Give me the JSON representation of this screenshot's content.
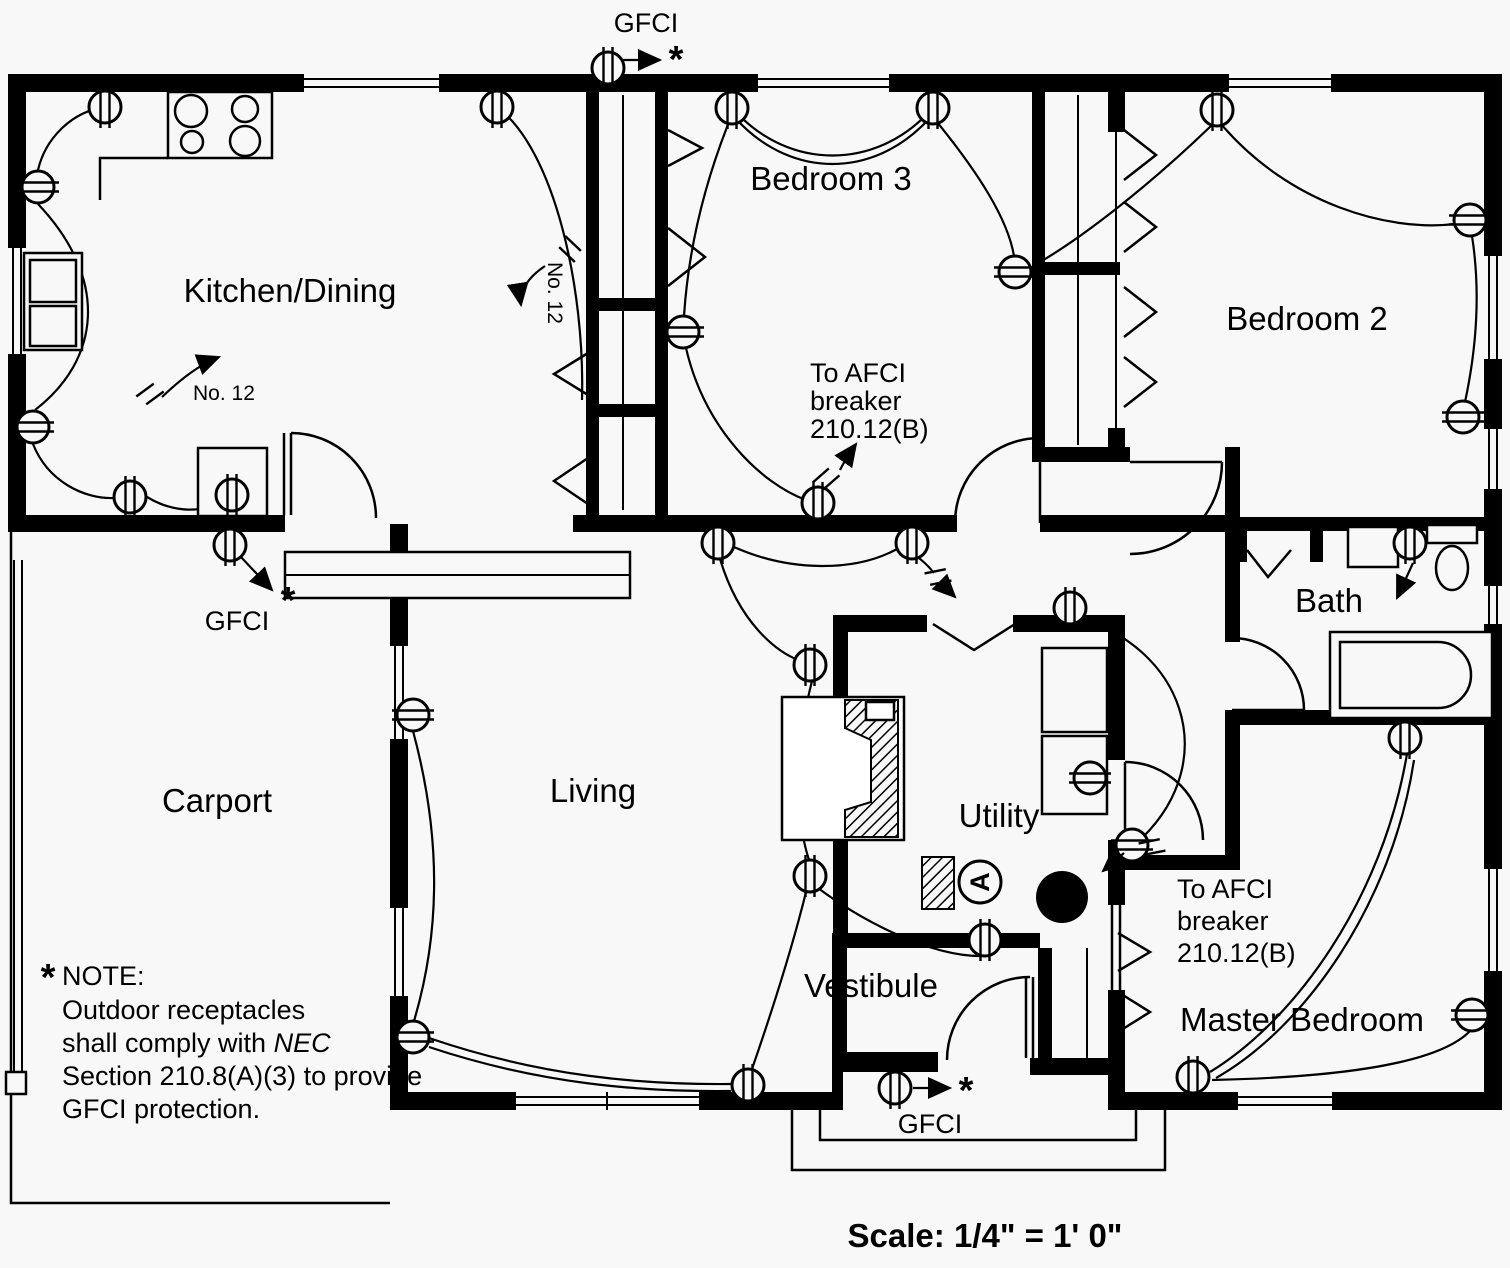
{
  "colors": {
    "background": "#f8f8f8",
    "ink": "#000000"
  },
  "rooms": {
    "kitchen": "Kitchen/Dining",
    "bedroom3": "Bedroom 3",
    "bedroom2": "Bedroom 2",
    "carport": "Carport",
    "living": "Living",
    "utility": "Utility",
    "bath": "Bath",
    "vestibule": "Vestibule",
    "master": "Master Bedroom"
  },
  "annotations": {
    "gfci": "GFCI",
    "asterisk": "*",
    "wire_gauge": "No. 12",
    "special_outlet_letter": "A",
    "afci": {
      "l1": "To AFCI",
      "l2": "breaker",
      "l3": "210.12(B)"
    },
    "note": {
      "marker": "*",
      "heading": "NOTE:",
      "l1": "Outdoor receptacles",
      "l2a": "shall comply with ",
      "l2b": "NEC",
      "l3": "Section 210.8(A)(3) to provide",
      "l4": "GFCI protection."
    },
    "scale": "Scale: 1/4\" = 1' 0\""
  },
  "symbols": {
    "duplex_receptacle": "circle-with-two-bars",
    "wire_run": "curved-line",
    "conductor_ticks": "double-slash",
    "water_heater": "filled-circle",
    "special_outlet": "circle-letter-A",
    "range": "four-burner-cooktop",
    "door_swing": "quarter-arc",
    "closet_rod": "chevron",
    "window": "double-line-in-wall"
  }
}
